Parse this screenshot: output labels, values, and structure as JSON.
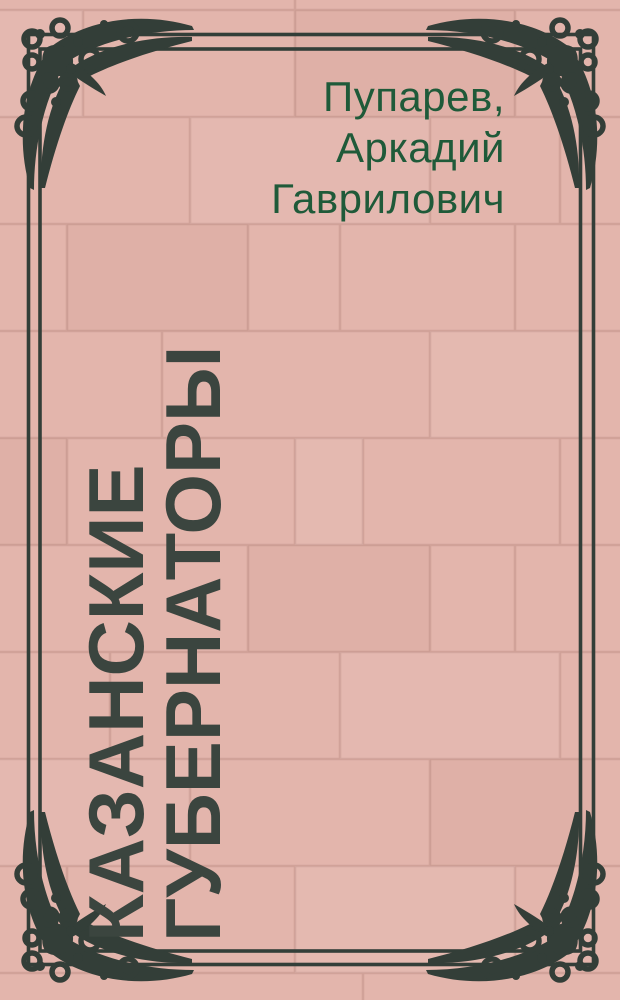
{
  "page": {
    "author_block": {
      "full_name": "Пупарев, Аркадий Гаврилович",
      "lines": [
        "Пупарев,",
        "Аркадий",
        "Гаврилович"
      ]
    },
    "title_block": {
      "full_title": "КАЗАНСКИЕ ГУБЕРНАТОРЫ",
      "lines": [
        "КАЗАНСКИЕ",
        "ГУБЕРНАТОРЫ"
      ]
    },
    "colors": {
      "tile_background": "#e3b5ac",
      "tile_grout": "#d0a198",
      "frame_and_ornament": "#333e38",
      "title_text": "#3b453f",
      "author_text": "#1f5a39"
    }
  }
}
